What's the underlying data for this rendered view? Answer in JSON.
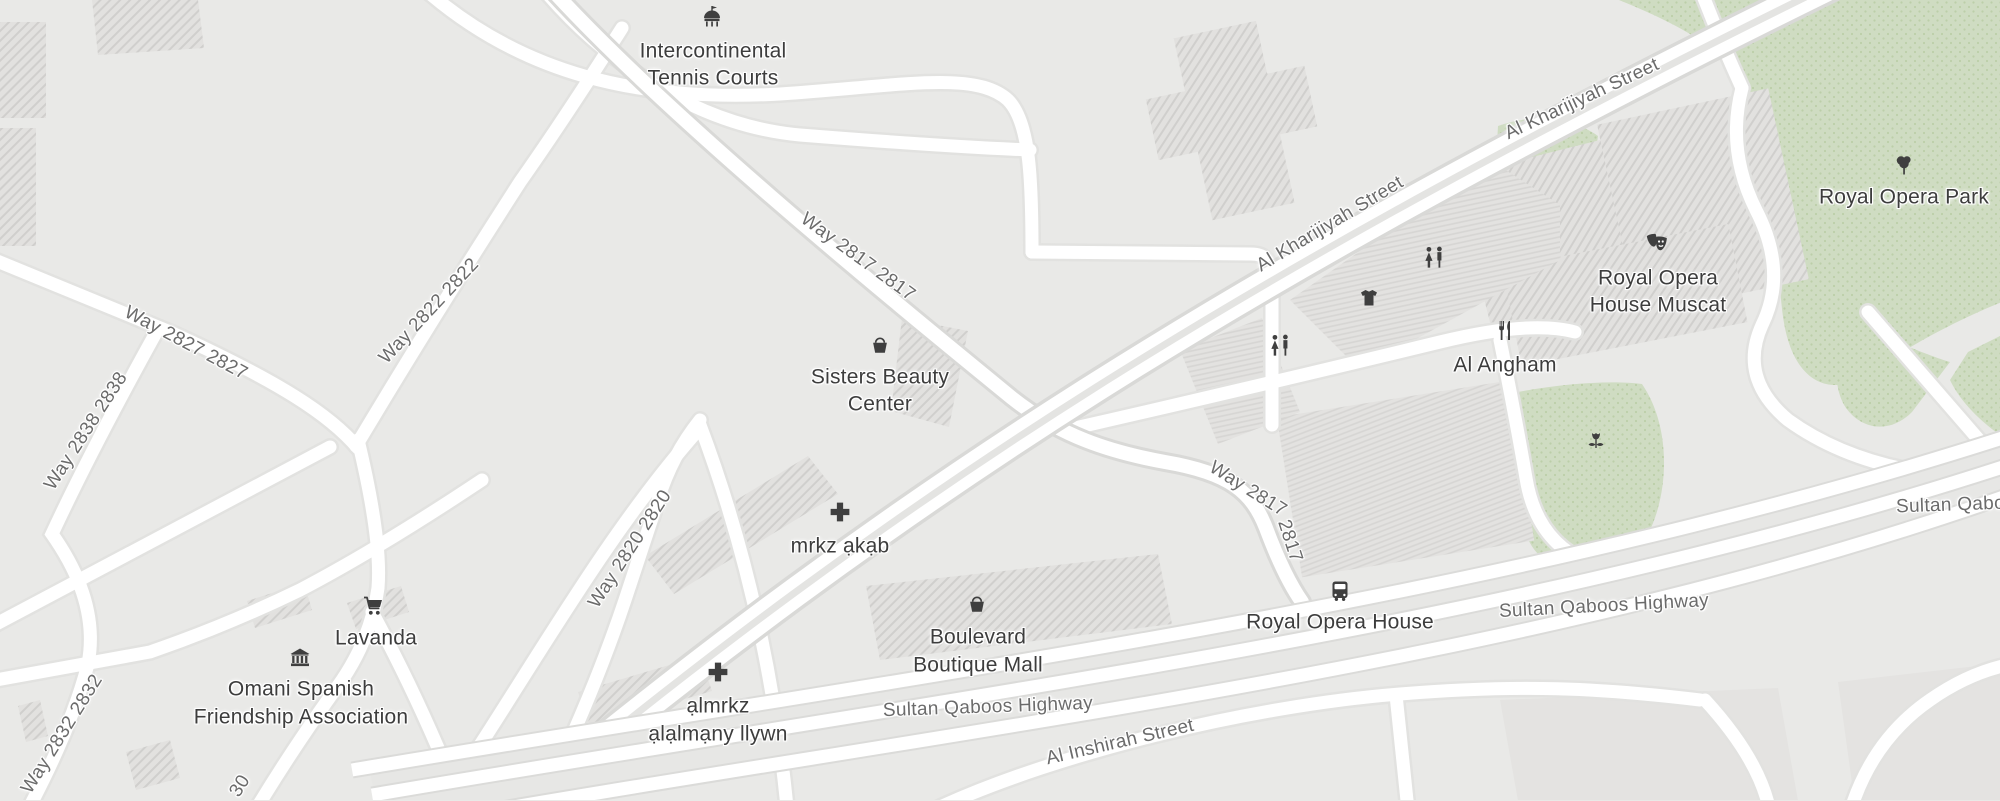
{
  "map_title": "Royal Opera House Muscat area map",
  "colors": {
    "background": "#e9e9e7",
    "park_green": "#cfdcc2",
    "park_dot": "#bccfa9",
    "road_white": "#ffffff",
    "road_casing": "#d9d9d7",
    "building_hatch": "#d0cfcd",
    "poi_text": "#3d3d3d",
    "road_text": "#6b6b6b",
    "icon_color": "#3f3f3f"
  },
  "pois": {
    "tennis": {
      "line1": "Intercontinental",
      "line2": "Tennis Courts",
      "icon": "attraction-icon"
    },
    "sisters": {
      "line1": "Sisters Beauty",
      "line2": "Center",
      "icon": "shop-basket-icon"
    },
    "mrkz_akab": {
      "label": "mrkz ạkạb",
      "icon": "medical-cross-icon"
    },
    "lavanda": {
      "label": "Lavanda",
      "icon": "shopping-cart-icon"
    },
    "omani": {
      "line1": "Omani Spanish",
      "line2": "Friendship Association",
      "icon": "museum-icon"
    },
    "boulevard": {
      "line1": "Boulevard",
      "line2": "Boutique Mall",
      "icon": "shop-basket-icon"
    },
    "almrkz": {
      "line1": "ạlmrkz",
      "line2": "ạlạlmạny llywn",
      "icon": "medical-cross-icon"
    },
    "opera_stop": {
      "label": "Royal Opera House",
      "icon": "bus-icon"
    },
    "angham": {
      "label": "Al Angham",
      "icon": "restaurant-icon"
    },
    "opera_house": {
      "line1": "Royal Opera",
      "line2": "House Muscat",
      "icon": "theater-masks-icon"
    },
    "opera_park": {
      "label": "Royal Opera Park",
      "icon": "tree-icon"
    }
  },
  "unlabeled_icons": [
    "clothing-store-icon",
    "toilets-icon",
    "toilets-icon",
    "garden-flower-icon"
  ],
  "road_labels": {
    "kharijiyah_1": "Al Kharijiyah Street",
    "kharijiyah_2": "Al Kharijiyah Street",
    "way2817_a": "Way 2817 2817",
    "way2817_b1": "Way 2817",
    "way2817_b2": "2817",
    "way2820": "Way 2820 2820",
    "way2822": "Way 2822 2822",
    "way2827": "Way 2827 2827",
    "way2838": "Way 2838 2838",
    "way2832": "Way 2832 2832",
    "way2830_partial": "30",
    "sqh_1": "Sultan Qaboos Highway",
    "sqh_2": "Sultan Qaboos Highway",
    "sqh_3_cut": "Sultan Qabo",
    "inshirah": "Al Inshirah Street"
  }
}
